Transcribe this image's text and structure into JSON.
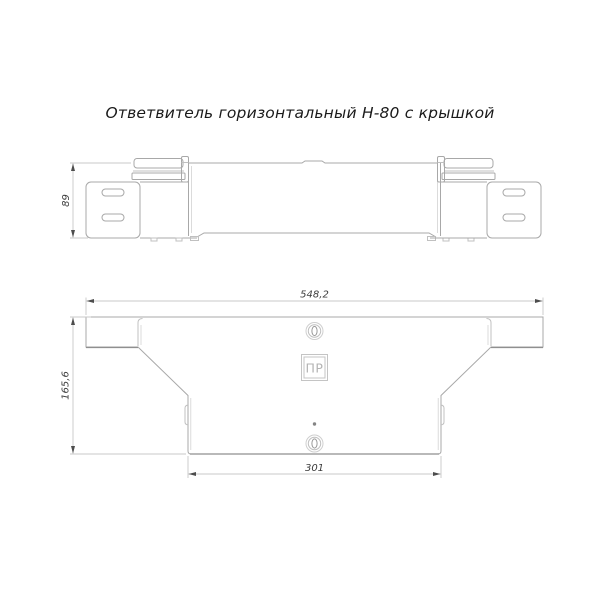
{
  "title": "Ответвитель горизонтальный Н-80 с крышкой",
  "dimensions": {
    "side_height": "89",
    "overall_width": "548,2",
    "overall_depth": "165,6",
    "branch_width": "301"
  },
  "logo": {
    "text": "ПР"
  },
  "colors": {
    "background": "#ffffff",
    "outline": "#a8a8a8",
    "thin_line": "#d2d2d2",
    "dimension_line": "#c9c9c9",
    "arrow": "#4d4d4d",
    "dimension_text": "#3c3c3c",
    "title_text": "#1a1a1a",
    "logo_gray": "#b3b3b3"
  }
}
